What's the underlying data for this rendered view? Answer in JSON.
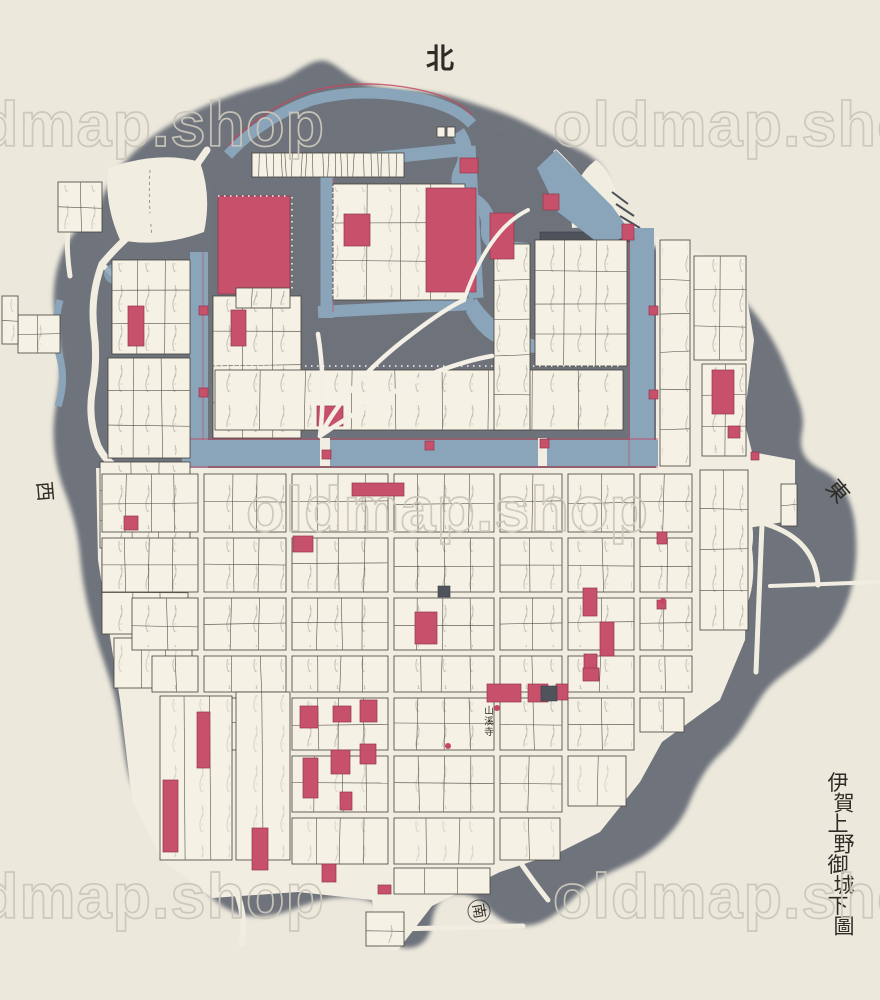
{
  "page": {
    "title_vertical": "伊賀上野御城下圖",
    "description": "hand-drawn castle town map"
  },
  "compass": {
    "north": "北",
    "east": "東",
    "west": "西",
    "south": "南"
  },
  "watermark": {
    "text": "oldmap.shop"
  },
  "labels": {
    "temple": "山溪寺"
  },
  "palette": {
    "paper": "#ECE8DC",
    "street": "#F1EDE0",
    "plot": "#F5F1E5",
    "land_gray": "#6E737B",
    "moat_blue": "#8AA4BA",
    "building_red": "#C7506A",
    "ink": "#2F2B26",
    "watermark": "#CBC7B9"
  }
}
